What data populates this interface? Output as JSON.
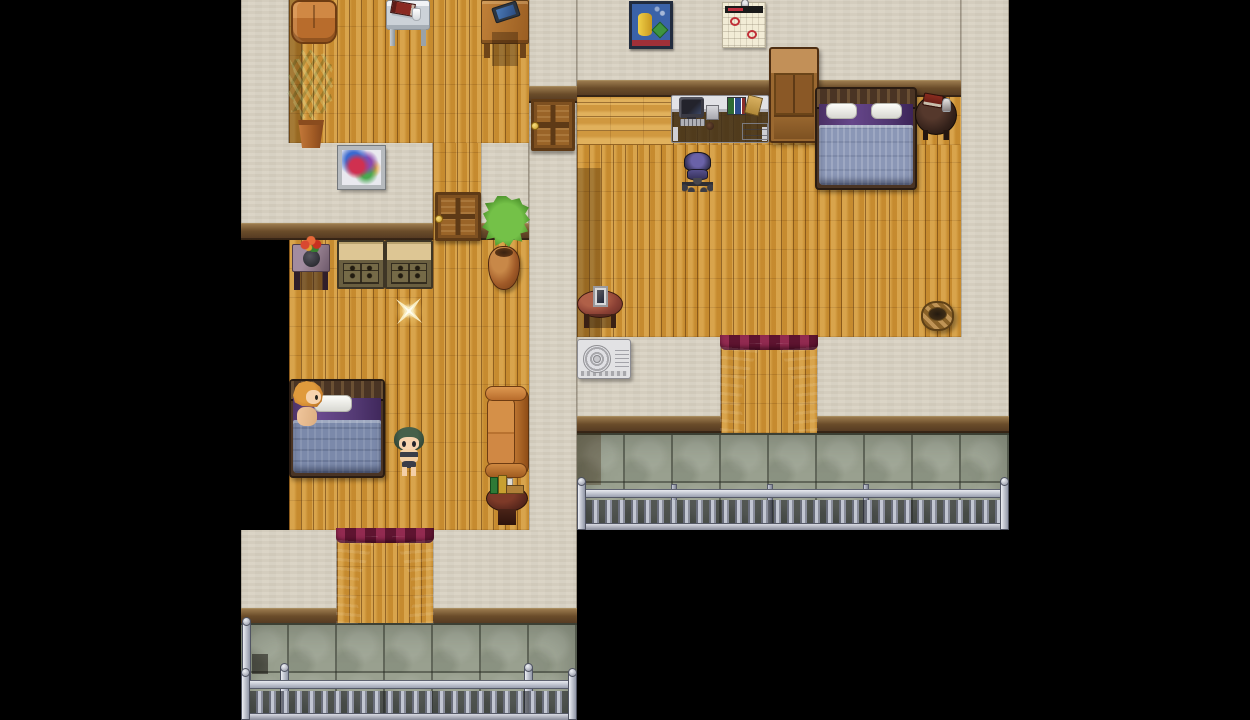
{
  "meta": {
    "app": "rpg-maker-style-game-scene",
    "canvas": {
      "width": 1250,
      "height": 720
    },
    "tile_size": 48,
    "game_area": {
      "x": 241,
      "y": 0,
      "width": 768,
      "height": 720
    },
    "letterbox_color": "#000000"
  },
  "palette": {
    "wall": "#d9d2c3",
    "baseboard": "#6a4c2a",
    "wood_floor": "#cf9434",
    "wood_floor_light": "#d9a246",
    "stone_balcony": "#99a08f",
    "railing_metal": "#b8bcc8",
    "curtain": "#7c1f40",
    "sofa_leather": "#c87838",
    "blanket_blue": "#7b89aa",
    "sheet_purple": "#5c4178",
    "sparkle_gold": "#f8ecc0"
  },
  "regions": [
    {
      "name": "left-wall-upper-left",
      "type": "wall",
      "x": 241,
      "y": 0,
      "w": 48,
      "h": 143,
      "i": false
    },
    {
      "name": "left-floor-upper",
      "type": "floor-v",
      "x": 289,
      "y": 0,
      "w": 240,
      "h": 143,
      "i": false
    },
    {
      "name": "left-floor-upper-shadow",
      "type": "shade",
      "x": 289,
      "y": 0,
      "w": 14,
      "h": 143,
      "i": false
    },
    {
      "name": "left-wall-mid",
      "type": "wall-band",
      "x": 241,
      "y": 143,
      "w": 192,
      "h": 97,
      "i": false
    },
    {
      "name": "left-hall-floor",
      "type": "floor-v",
      "x": 433,
      "y": 143,
      "w": 48,
      "h": 97,
      "i": false
    },
    {
      "name": "left-wall-mid-right",
      "type": "wall-band",
      "x": 481,
      "y": 143,
      "w": 48,
      "h": 97,
      "i": false
    },
    {
      "name": "left-wall-right-top",
      "type": "wall-band",
      "x": 529,
      "y": 0,
      "w": 48,
      "h": 103,
      "i": false
    },
    {
      "name": "left-wall-right",
      "type": "wall",
      "x": 529,
      "y": 103,
      "w": 48,
      "h": 427,
      "i": false
    },
    {
      "name": "left-floor-lower",
      "type": "floor-v",
      "x": 289,
      "y": 240,
      "w": 240,
      "h": 290,
      "i": false
    },
    {
      "name": "left-band-bottom-a",
      "type": "wall-band",
      "x": 241,
      "y": 530,
      "w": 96,
      "h": 95,
      "i": false
    },
    {
      "name": "left-passage-floor",
      "type": "floor-v",
      "x": 337,
      "y": 530,
      "w": 96,
      "h": 95,
      "i": false
    },
    {
      "name": "left-band-bottom-b",
      "type": "wall-band",
      "x": 433,
      "y": 530,
      "w": 144,
      "h": 95,
      "i": false
    },
    {
      "name": "left-balcony-stone",
      "type": "stone",
      "x": 241,
      "y": 623,
      "w": 336,
      "h": 97,
      "i": false
    },
    {
      "name": "right-wall-top",
      "type": "wall-band",
      "x": 577,
      "y": 0,
      "w": 384,
      "h": 97,
      "i": false
    },
    {
      "name": "right-wall-column",
      "type": "wall",
      "x": 961,
      "y": 0,
      "w": 48,
      "h": 337,
      "i": false
    },
    {
      "name": "right-floor-entry",
      "type": "floor-h",
      "x": 577,
      "y": 97,
      "w": 96,
      "h": 48,
      "i": false
    },
    {
      "name": "right-floor-a",
      "type": "floor-v",
      "x": 673,
      "y": 97,
      "w": 288,
      "h": 48,
      "i": false
    },
    {
      "name": "right-floor-b",
      "type": "floor-v",
      "x": 577,
      "y": 145,
      "w": 384,
      "h": 192,
      "i": false
    },
    {
      "name": "right-floor-shadow",
      "type": "shade",
      "x": 577,
      "y": 168,
      "w": 24,
      "h": 169,
      "i": false
    },
    {
      "name": "right-band-bottom-a",
      "type": "wall-band",
      "x": 577,
      "y": 337,
      "w": 144,
      "h": 96,
      "i": false
    },
    {
      "name": "right-passage-floor",
      "type": "floor-v",
      "x": 721,
      "y": 337,
      "w": 96,
      "h": 96,
      "i": false
    },
    {
      "name": "right-band-bottom-b",
      "type": "wall-band",
      "x": 817,
      "y": 337,
      "w": 192,
      "h": 96,
      "i": false
    },
    {
      "name": "right-balcony-stone",
      "type": "stone",
      "x": 577,
      "y": 433,
      "w": 432,
      "h": 97,
      "i": false
    },
    {
      "name": "right-balcony-shadow",
      "type": "shade",
      "x": 577,
      "y": 433,
      "w": 24,
      "h": 52,
      "i": false
    }
  ],
  "objects": [
    {
      "name": "loveseat-back",
      "type": "sofa-top",
      "x": 291,
      "y": 0,
      "w": 46,
      "h": 44,
      "i": false
    },
    {
      "name": "glass-table",
      "type": "glass-table",
      "x": 386,
      "y": 0,
      "w": 44,
      "h": 46,
      "i": false,
      "parts": [
        "book",
        "cup"
      ]
    },
    {
      "name": "side-desk",
      "type": "side-desk",
      "x": 481,
      "y": 0,
      "w": 48,
      "h": 58,
      "i": false,
      "parts": [
        "tablet"
      ]
    },
    {
      "name": "potted-plant",
      "type": "plant",
      "x": 287,
      "y": 50,
      "w": 48,
      "h": 98,
      "i": false,
      "parts": [
        "leaves",
        "pot"
      ]
    },
    {
      "name": "abstract-painting",
      "type": "painting",
      "x": 338,
      "y": 146,
      "w": 47,
      "h": 43,
      "i": false
    },
    {
      "name": "hall-door",
      "type": "door",
      "x": 435,
      "y": 192,
      "w": 46,
      "h": 49,
      "i": true
    },
    {
      "name": "side-door",
      "type": "door",
      "x": 531,
      "y": 99,
      "w": 44,
      "h": 52,
      "i": true
    },
    {
      "name": "flower-stand",
      "type": "flower-table",
      "x": 292,
      "y": 238,
      "w": 38,
      "h": 52,
      "i": false,
      "parts": [
        "vase",
        "flowers"
      ]
    },
    {
      "name": "dresser-a",
      "type": "dresser",
      "x": 337,
      "y": 240,
      "w": 48,
      "h": 49,
      "i": false
    },
    {
      "name": "dresser-b",
      "type": "dresser",
      "x": 385,
      "y": 240,
      "w": 48,
      "h": 49,
      "i": false
    },
    {
      "name": "wall-plant",
      "type": "bush",
      "x": 482,
      "y": 196,
      "w": 48,
      "h": 52,
      "i": false,
      "parts": [
        "leaves"
      ]
    },
    {
      "name": "clay-urn",
      "type": "urn",
      "x": 488,
      "y": 246,
      "w": 32,
      "h": 44,
      "i": false
    },
    {
      "name": "sparkle-pickup",
      "type": "sparkle",
      "x": 392,
      "y": 294,
      "w": 34,
      "h": 34,
      "i": true
    },
    {
      "name": "bed-left",
      "type": "bed",
      "x": 289,
      "y": 379,
      "w": 96,
      "h": 99,
      "i": false,
      "parts": [
        "headboard",
        "sheet",
        "pillow-a",
        "blanket"
      ]
    },
    {
      "name": "sleeping-npc",
      "type": "npc",
      "x": 291,
      "y": 381,
      "w": 36,
      "h": 48,
      "i": true,
      "parts": [
        "hair",
        "face",
        "torso"
      ]
    },
    {
      "name": "player-character",
      "type": "player",
      "x": 393,
      "y": 427,
      "w": 32,
      "h": 50,
      "i": true,
      "parts": [
        "hair",
        "face",
        "torso",
        "briefs",
        "leg-l",
        "leg-r"
      ]
    },
    {
      "name": "leather-sofa",
      "type": "sofa-vert",
      "x": 485,
      "y": 386,
      "w": 44,
      "h": 92,
      "i": false,
      "parts": [
        "back",
        "cushions",
        "arm-top",
        "arm-bottom"
      ]
    },
    {
      "name": "book-table",
      "type": "table-books",
      "x": 486,
      "y": 477,
      "w": 42,
      "h": 48,
      "i": false,
      "parts": [
        "book-g",
        "book-y",
        "book-w",
        "book-flat"
      ]
    },
    {
      "name": "left-doorway-curtain",
      "type": "curtain",
      "x": 336,
      "y": 528,
      "w": 98,
      "h": 96,
      "i": true,
      "parts": [
        "valance",
        "drape-l",
        "drape-r"
      ]
    },
    {
      "name": "balcony-post-shadow",
      "type": "shade-sq",
      "x": 252,
      "y": 654,
      "w": 16,
      "h": 20,
      "i": false
    },
    {
      "name": "left-railing-post-tall",
      "type": "post-tall",
      "x": 242,
      "y": 622,
      "w": 9,
      "h": 58,
      "i": false
    },
    {
      "name": "left-railing",
      "type": "railing",
      "x": 241,
      "y": 670,
      "w": 336,
      "h": 50,
      "i": false,
      "parts": [
        "rail-top",
        "balusters",
        "rail-bottom",
        "post-l",
        "post-r"
      ]
    },
    {
      "name": "left-railing-post-a",
      "type": "post",
      "x": 280,
      "y": 668,
      "w": 9,
      "h": 52,
      "i": false
    },
    {
      "name": "left-railing-post-b",
      "type": "post",
      "x": 524,
      "y": 668,
      "w": 9,
      "h": 52,
      "i": false
    },
    {
      "name": "wall-poster",
      "type": "poster",
      "x": 629,
      "y": 1,
      "w": 44,
      "h": 48,
      "i": false
    },
    {
      "name": "wall-calendar",
      "type": "calendar",
      "x": 722,
      "y": 2,
      "w": 44,
      "h": 46,
      "i": false,
      "parts": [
        "pin",
        "header",
        "ring-a",
        "ring-b"
      ]
    },
    {
      "name": "wardrobe",
      "type": "wardrobe",
      "x": 769,
      "y": 47,
      "w": 50,
      "h": 96,
      "i": true
    },
    {
      "name": "computer-desk",
      "type": "desk",
      "x": 671,
      "y": 95,
      "w": 98,
      "h": 48,
      "i": false,
      "parts": [
        "monitor",
        "keyboard",
        "tower",
        "mug",
        "binders",
        "lean-book",
        "drawers"
      ]
    },
    {
      "name": "bed-right",
      "type": "bed-r",
      "x": 815,
      "y": 87,
      "w": 102,
      "h": 103,
      "i": false,
      "parts": [
        "headboard",
        "sheet",
        "pillow-a",
        "pillow-b",
        "blanket"
      ]
    },
    {
      "name": "nightstand",
      "type": "nightstand",
      "x": 915,
      "y": 95,
      "w": 42,
      "h": 40,
      "i": false,
      "parts": [
        "book",
        "glass"
      ]
    },
    {
      "name": "office-chair",
      "type": "chair",
      "x": 681,
      "y": 151,
      "w": 34,
      "h": 42,
      "i": false,
      "parts": [
        "backrest",
        "seat",
        "base"
      ]
    },
    {
      "name": "photo-table",
      "type": "table-photo",
      "x": 577,
      "y": 286,
      "w": 46,
      "h": 42,
      "i": false,
      "parts": [
        "photo"
      ]
    },
    {
      "name": "air-conditioner",
      "type": "ac",
      "x": 577,
      "y": 339,
      "w": 54,
      "h": 40,
      "i": false,
      "parts": [
        "fan",
        "vents"
      ]
    },
    {
      "name": "wicker-basket",
      "type": "basket",
      "x": 921,
      "y": 301,
      "w": 33,
      "h": 30,
      "i": false
    },
    {
      "name": "right-doorway-curtain",
      "type": "curtain",
      "x": 720,
      "y": 335,
      "w": 98,
      "h": 96,
      "i": true,
      "parts": [
        "valance",
        "drape-l",
        "drape-r"
      ]
    },
    {
      "name": "right-railing",
      "type": "railing",
      "x": 577,
      "y": 479,
      "w": 432,
      "h": 51,
      "i": false,
      "parts": [
        "rail-top",
        "balusters",
        "rail-bottom",
        "post-l",
        "post-r"
      ]
    },
    {
      "name": "right-railing-sep-a",
      "type": "sep",
      "x": 671,
      "y": 484,
      "w": 6,
      "h": 44,
      "i": false
    },
    {
      "name": "right-railing-sep-b",
      "type": "sep",
      "x": 767,
      "y": 484,
      "w": 6,
      "h": 44,
      "i": false
    },
    {
      "name": "right-railing-sep-c",
      "type": "sep",
      "x": 863,
      "y": 484,
      "w": 6,
      "h": 44,
      "i": false
    }
  ]
}
